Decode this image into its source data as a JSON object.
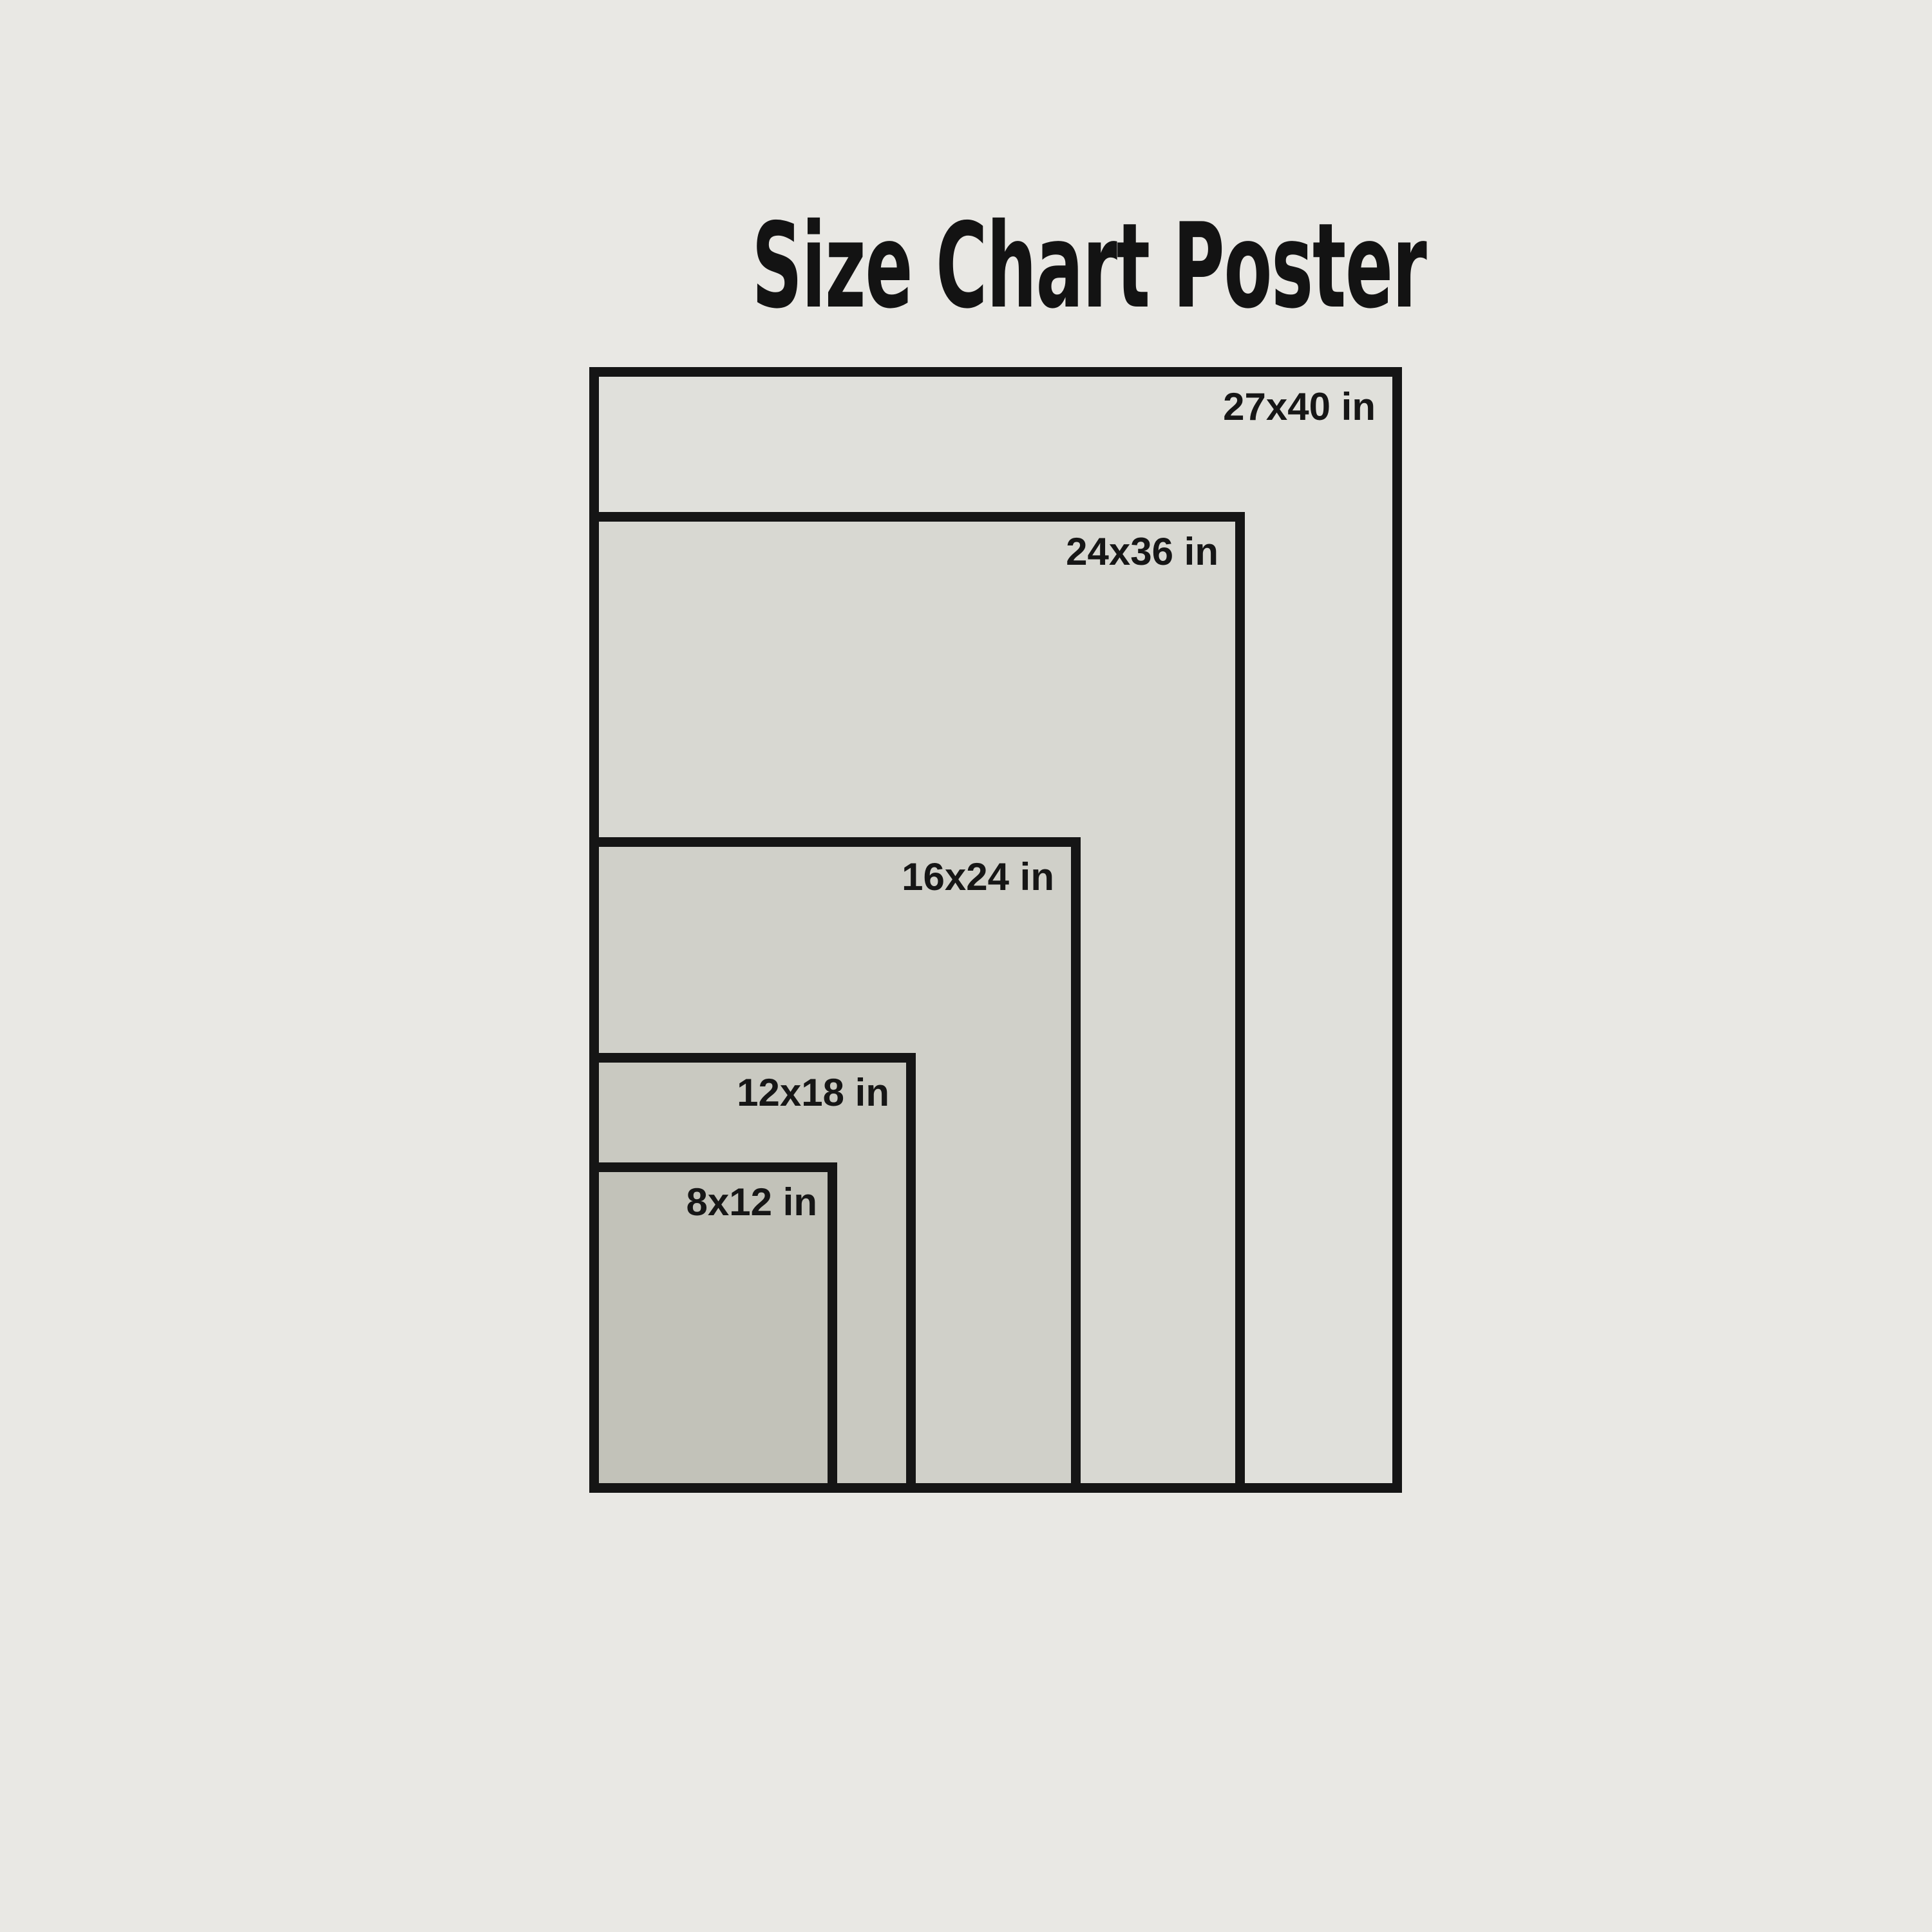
{
  "page": {
    "title": "Size Chart Poster"
  },
  "colors": {
    "background": "#e9e8e4",
    "rect_border": "#151515",
    "rect_fill_overlay": "rgba(40,40,30,0.045)",
    "text": "#161616"
  },
  "sizes": [
    {
      "id": "27x40",
      "label": "27x40 in",
      "width_in": 27,
      "height_in": 40
    },
    {
      "id": "24x36",
      "label": "24x36 in",
      "width_in": 24,
      "height_in": 36
    },
    {
      "id": "16x24",
      "label": "16x24 in",
      "width_in": 16,
      "height_in": 24
    },
    {
      "id": "12x18",
      "label": "12x18 in",
      "width_in": 12,
      "height_in": 18
    },
    {
      "id": "8x12",
      "label": "8x12 in",
      "width_in": 8,
      "height_in": 12
    }
  ]
}
